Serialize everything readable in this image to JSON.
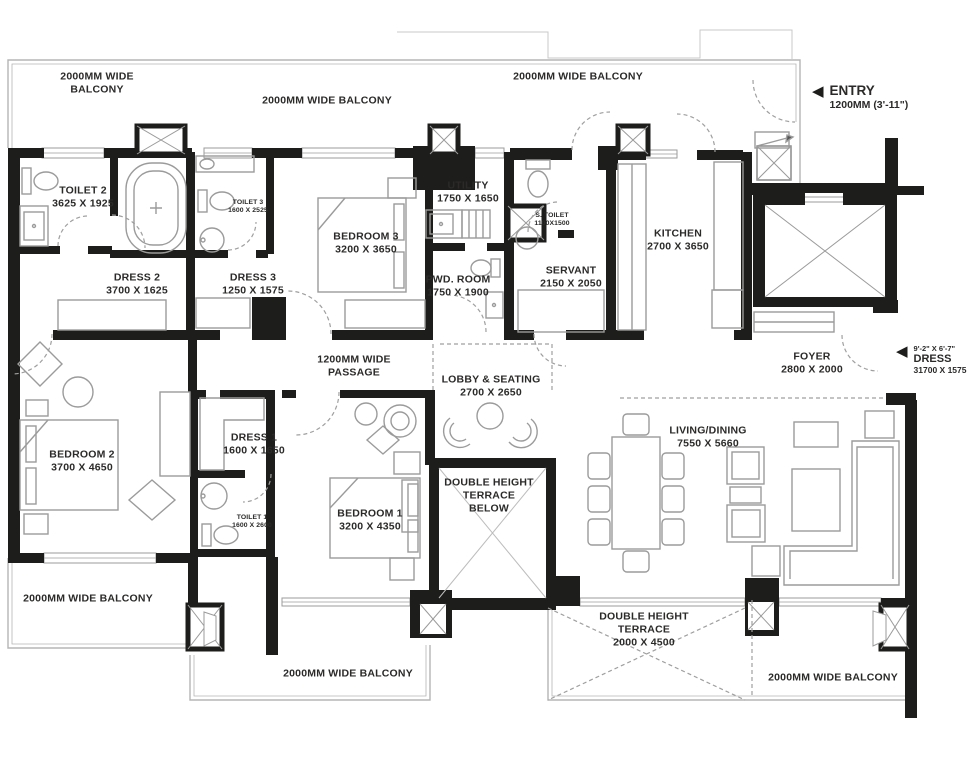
{
  "plan": {
    "type": "apartment-floor-plan",
    "colors": {
      "wall": "#1d1d1b",
      "line": "#9b9b9b",
      "rail": "#b5b5b5",
      "text": "#2b2a29"
    },
    "labels": {
      "balcony_tl": {
        "l1": "2000MM WIDE",
        "l2": "BALCONY"
      },
      "balcony_tm": {
        "l1": "2000MM WIDE BALCONY"
      },
      "balcony_tr": {
        "l1": "2000MM WIDE BALCONY"
      },
      "entry": {
        "l1": "ENTRY",
        "l2": "1200MM (3'-11\")"
      },
      "toilet2": {
        "l1": "TOILET 2",
        "l2": "3625 X 1925"
      },
      "toilet3": {
        "l1": "TOILET 3",
        "l2": "1600 X 2525"
      },
      "bedroom3": {
        "l1": "BEDROOM 3",
        "l2": "3200 X 3650"
      },
      "utility": {
        "l1": "UTILITY",
        "l2": "1750 X 1650"
      },
      "s_toilet": {
        "l1": "S. TOILET",
        "l2": "1100X1500"
      },
      "kitchen": {
        "l1": "KITCHEN",
        "l2": "2700 X 3650"
      },
      "dress2": {
        "l1": "DRESS 2",
        "l2": "3700 X 1625"
      },
      "dress3": {
        "l1": "DRESS 3",
        "l2": "1250 X 1575"
      },
      "pwd_room": {
        "l1": "PWD. ROOM",
        "l2": "1750 X 1900"
      },
      "servant": {
        "l1": "SERVANT",
        "l2": "2150 X 2050"
      },
      "foyer": {
        "l1": "FOYER",
        "l2": "2800 X 2000"
      },
      "dress_side": {
        "l1": "9'-2\" X 6'-7\"",
        "l2": "DRESS",
        "l3": "31700 X 1575"
      },
      "passage": {
        "l1": "1200MM WIDE",
        "l2": "PASSAGE"
      },
      "lobby": {
        "l1": "LOBBY & SEATING",
        "l2": "2700 X 2650"
      },
      "bedroom2": {
        "l1": "BEDROOM 2",
        "l2": "3700 X 4650"
      },
      "dress1": {
        "l1": "DRESS 1",
        "l2": "1600 X 1650"
      },
      "toilet1": {
        "l1": "TOILET 1",
        "l2": "1600 X 2600"
      },
      "bedroom1": {
        "l1": "BEDROOM 1",
        "l2": "3200 X 4350"
      },
      "dht_below": {
        "l1": "DOUBLE HEIGHT",
        "l2": "TERRACE",
        "l3": "BELOW"
      },
      "living": {
        "l1": "LIVING/DINING",
        "l2": "7550 X 5660"
      },
      "balcony_bl": {
        "l1": "2000MM WIDE BALCONY"
      },
      "balcony_bm": {
        "l1": "2000MM WIDE BALCONY"
      },
      "dht": {
        "l1": "DOUBLE HEIGHT",
        "l2": "TERRACE",
        "l3": "2000 X 4500"
      },
      "balcony_br": {
        "l1": "2000MM WIDE BALCONY"
      },
      "entry_arrow": "◀",
      "dress_arrow": "◀"
    }
  }
}
